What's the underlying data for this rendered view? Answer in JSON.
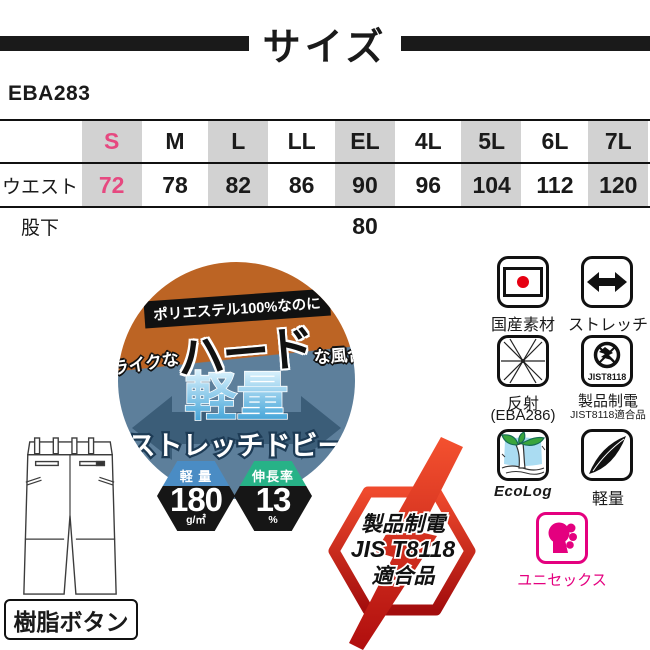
{
  "header": {
    "title": "サイズ",
    "product_code": "EBA283"
  },
  "size_table": {
    "columns": [
      "S",
      "M",
      "L",
      "LL",
      "EL",
      "4L",
      "5L",
      "6L",
      "7L"
    ],
    "waist_label": "ウエスト",
    "waist_values": [
      "72",
      "78",
      "82",
      "86",
      "90",
      "96",
      "104",
      "112",
      "120"
    ],
    "inseam_label": "股下",
    "inseam_value": "80",
    "highlight_color": "#e64980",
    "stripe_color": "#d2d2d2"
  },
  "fabric_badge": {
    "banner": "ポリエステル100%なのに",
    "texture_prefix": "綿ライクな",
    "texture_main": "ハード",
    "texture_suffix": "な風合い",
    "feature": "軽量",
    "fabric_name": "ストレッチドビー",
    "top_color": "#bc6424",
    "bottom_color": "#5d7f9b",
    "arrow_color": "#3b5d78"
  },
  "spec_hexagons": {
    "weight": {
      "title": "軽 量",
      "value": "180",
      "unit": "g/㎡",
      "color": "#4a8cc4"
    },
    "stretch": {
      "title": "伸長率",
      "value": "13",
      "unit": "%",
      "color": "#27b287"
    }
  },
  "antistatic_emblem": {
    "line1": "製品制電",
    "line2": "JIS T8118",
    "line3": "適合品",
    "color": "#cf1315"
  },
  "pants": {
    "label": "樹脂ボタン"
  },
  "feature_icons": {
    "domestic": {
      "label": "国産素材"
    },
    "stretch": {
      "label": "ストレッチ"
    },
    "reflective": {
      "label": "反射",
      "sublabel": "(EBA286)"
    },
    "antistatic": {
      "label": "製品制電",
      "sublabel": "JIST8118適合品",
      "badge": "JIST8118"
    },
    "ecolog": {
      "label": "EcoLog"
    },
    "lightweight": {
      "label": "軽量"
    },
    "unisex": {
      "label": "ユニセックス",
      "color": "#e4007f"
    }
  }
}
